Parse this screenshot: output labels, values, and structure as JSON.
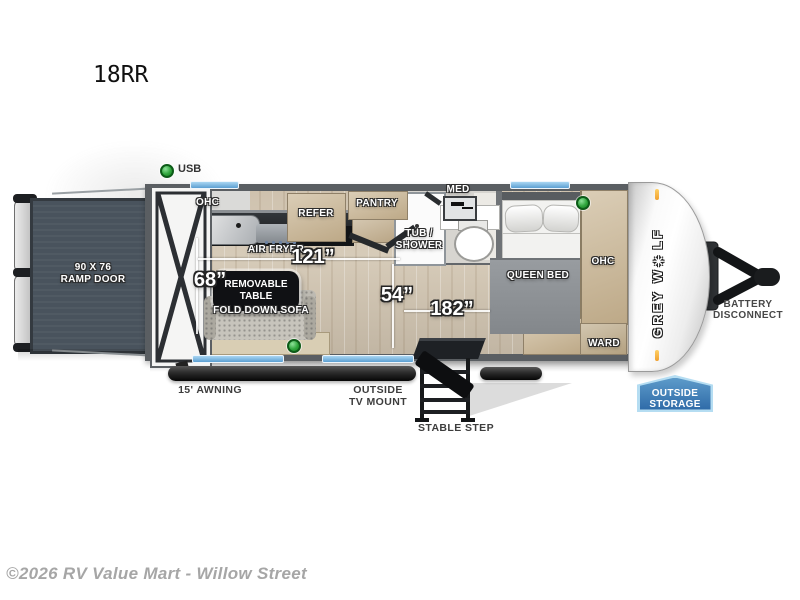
{
  "page": {
    "model": "18RR",
    "copyright": "©2026 RV Value Mart - Willow Street"
  },
  "legend": {
    "usb": "USB"
  },
  "plan": {
    "ramp_door_l1": "90 X 76",
    "ramp_door_l2": "RAMP DOOR",
    "kitchen_ohc": "OHC",
    "refer": "REFER",
    "pantry": "PANTRY",
    "air_fryer": "AIR FRYER",
    "tub_l1": "TUB /",
    "tub_l2": "SHOWER",
    "med": "MED",
    "queen_bed": "QUEEN BED",
    "bed_ohc": "OHC",
    "ward": "WARD",
    "sofa": "FOLD DOWN SOFA",
    "table_l1": "REMOVABLE",
    "table_l2": "TABLE",
    "m68": "68”",
    "m121": "121”",
    "m54": "54”",
    "m182": "182”"
  },
  "exterior": {
    "awning": "15' AWNING",
    "tv_l1": "OUTSIDE",
    "tv_l2": "TV MOUNT",
    "step": "STABLE STEP",
    "battery_l1": "BATTERY",
    "battery_l2": "DISCONNECT",
    "storage_l1": "OUTSIDE",
    "storage_l2": "STORAGE",
    "brand": "GREY W✳LF"
  },
  "colors": {
    "usb_green": "#2fa53c",
    "window_blue": "#5c9fd2",
    "storage_blue": "#2f6ba8",
    "wood": "#cbb897",
    "marker_orange": "#f0a030",
    "wall_gray": "#5a5e62"
  }
}
